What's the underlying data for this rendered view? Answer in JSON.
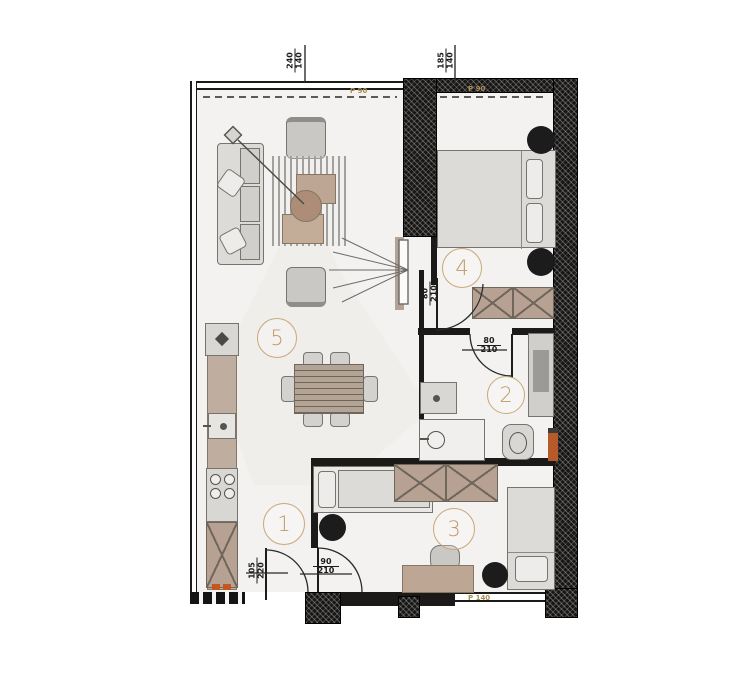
{
  "plan": {
    "rooms": [
      {
        "label": "1"
      },
      {
        "label": "2"
      },
      {
        "label": "3"
      },
      {
        "label": "4"
      },
      {
        "label": "5"
      }
    ],
    "doors": {
      "entrance": {
        "width": "105",
        "height": "220"
      },
      "room3": {
        "width": "90",
        "height": "210"
      },
      "room4": {
        "width": "80",
        "height": "210"
      },
      "bathroom": {
        "width": "80",
        "height": "210"
      }
    },
    "window_callouts": {
      "top_left": {
        "width": "240",
        "height": "140"
      },
      "top_right": {
        "width": "185",
        "height": "140"
      }
    },
    "annotations": {
      "parapet_top_left": "P 90",
      "parapet_top_right": "P 90",
      "parapet_bottom": "P 140"
    },
    "colors": {
      "accent_tan": "#c09a66",
      "furniture_tan": "#b7a193",
      "wall_black": "#1b1a18",
      "orange_accent": "#c2571f"
    }
  }
}
